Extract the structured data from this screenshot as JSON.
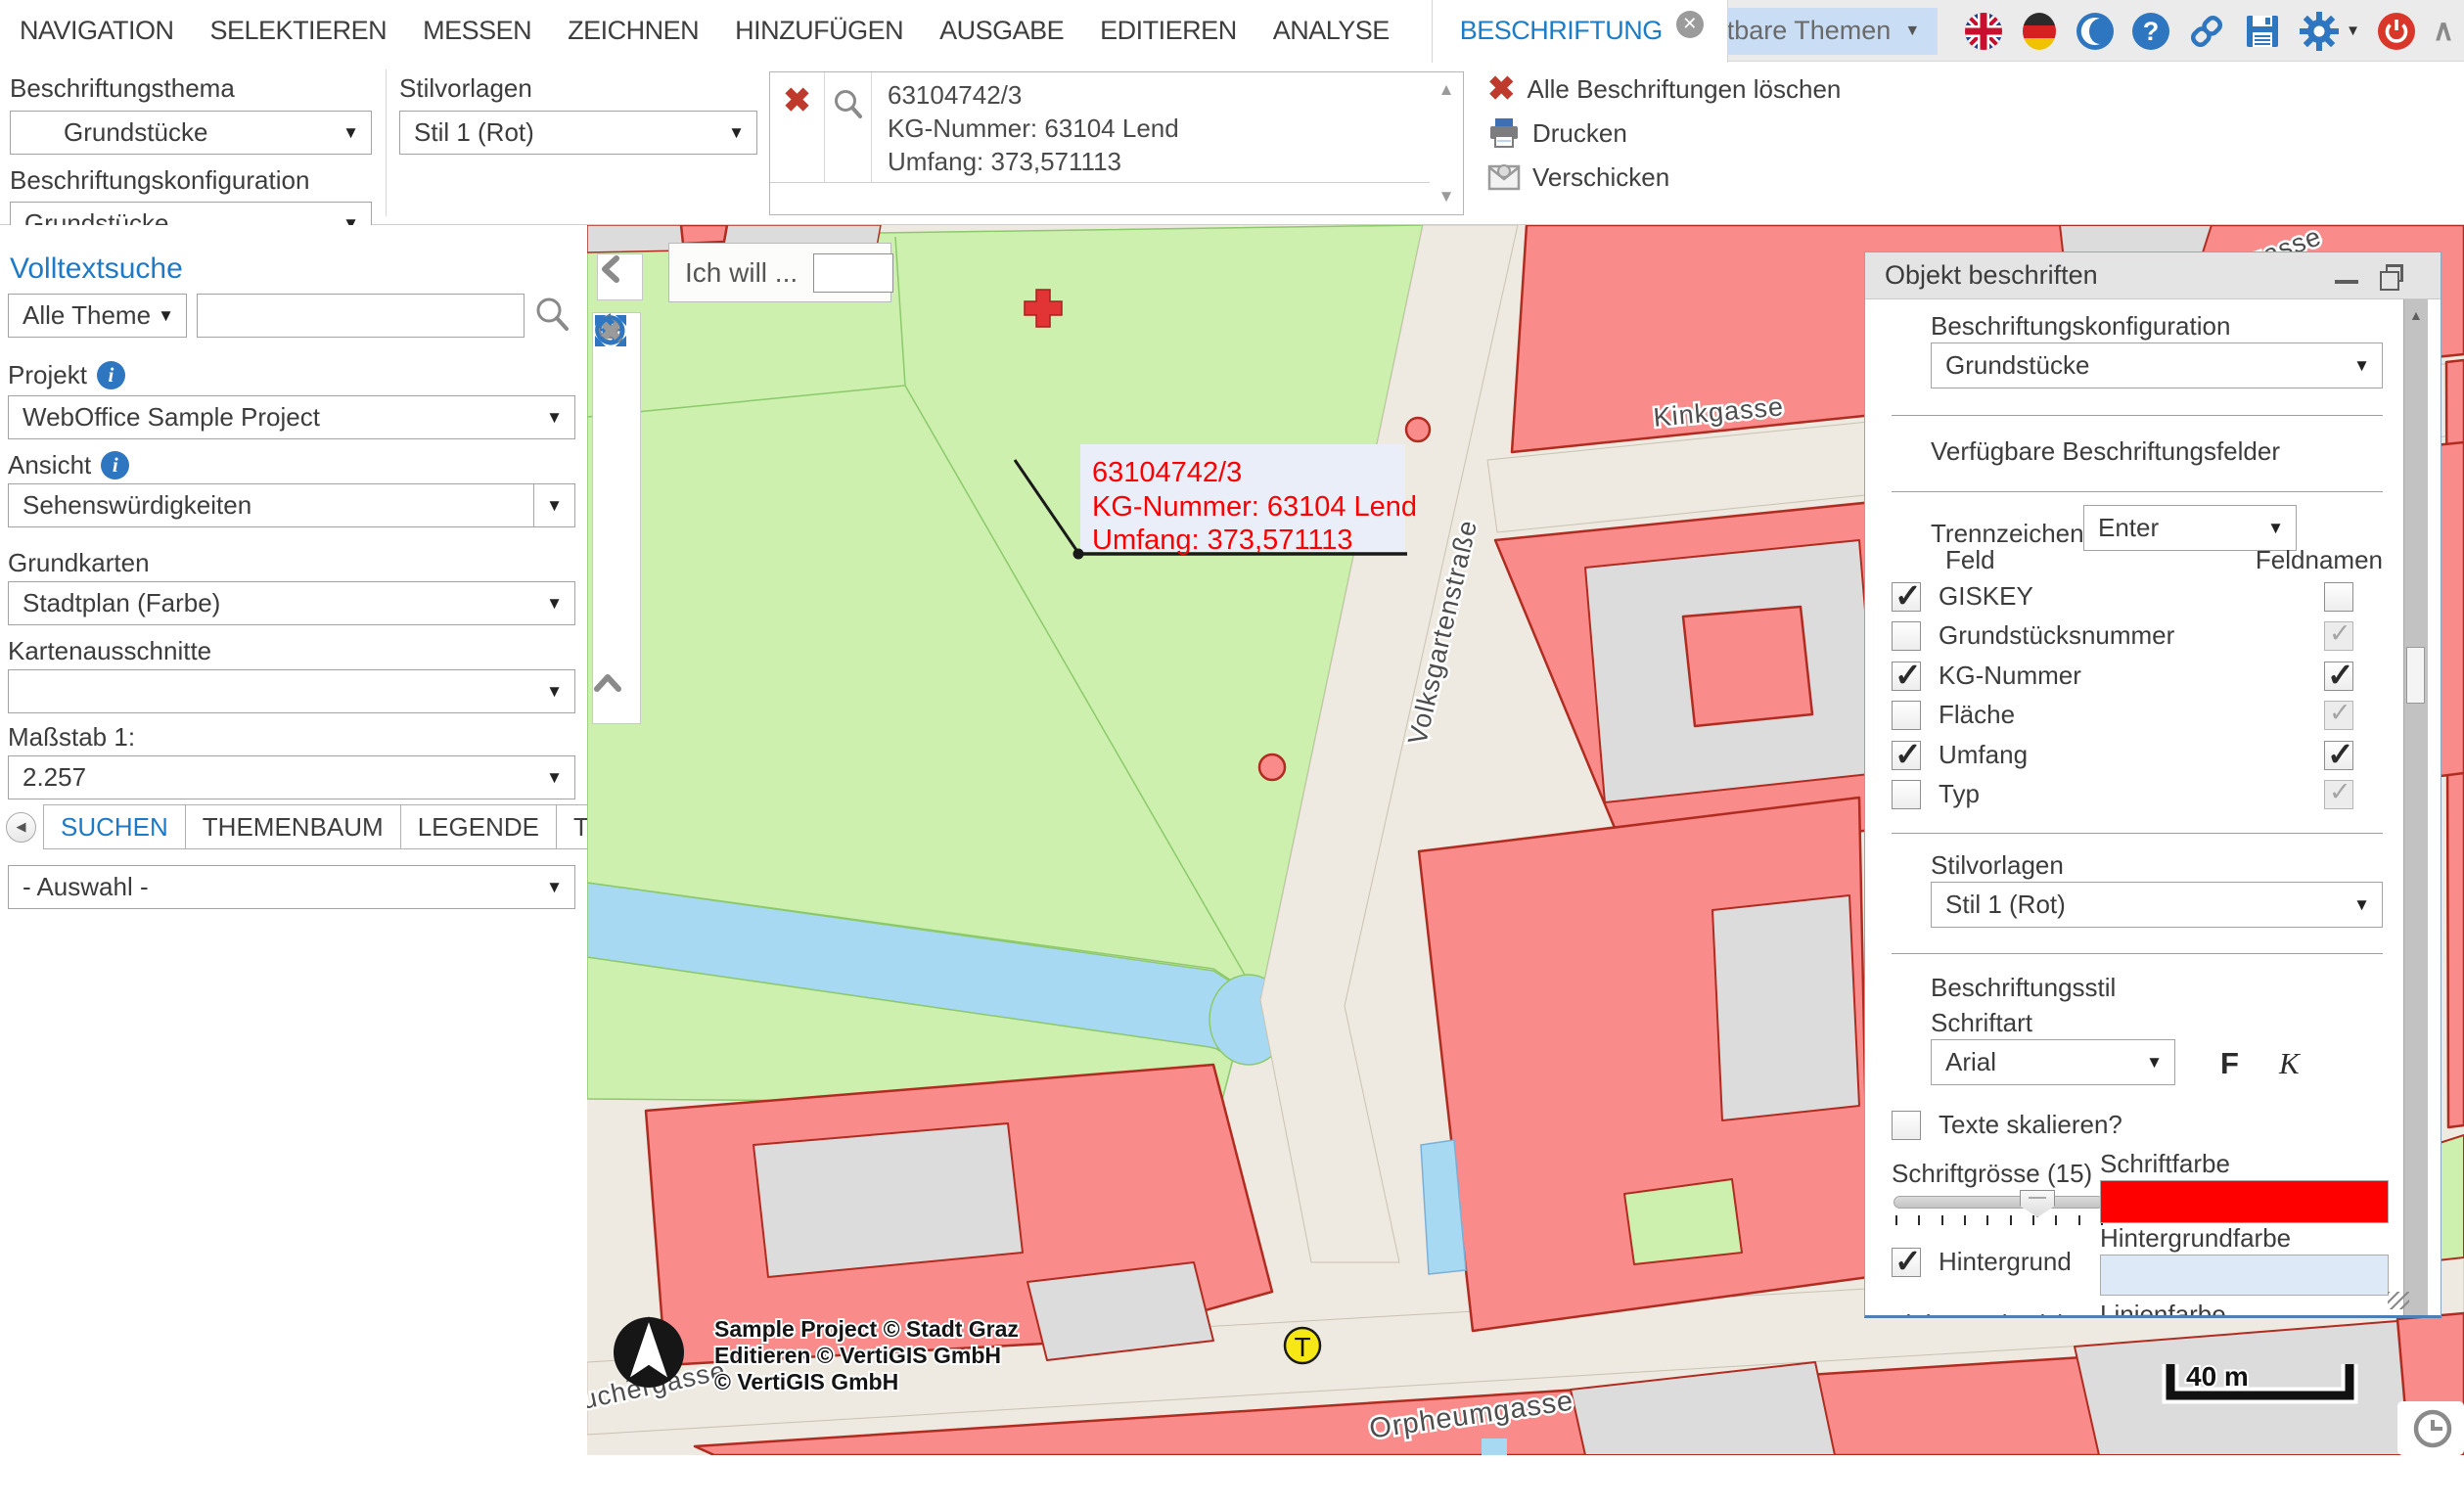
{
  "app": {
    "menu": [
      "NAVIGATION",
      "SELEKTIEREN",
      "MESSEN",
      "ZEICHNEN",
      "HINZUFÜGEN",
      "AUSGABE",
      "EDITIEREN",
      "ANALYSE"
    ],
    "active_tab": "BESCHRIFTUNG",
    "visible_themes_label": "Sichtbare Themen",
    "accent_color": "#1c7cc5"
  },
  "toolbar": {
    "beschriftungsthema_label": "Beschriftungsthema",
    "beschriftungsthema_value": "Grundstücke",
    "beschriftungskonfiguration_label": "Beschriftungskonfiguration",
    "beschriftungskonfiguration_value": "Grundstücke",
    "stilvorlagen_label": "Stilvorlagen",
    "stilvorlagen_value": "Stil 1 (Rot)",
    "result_item": {
      "line1": "63104742/3",
      "line2": "KG-Nummer: 63104 Lend",
      "line3": "Umfang: 373,571113"
    },
    "commands": [
      {
        "label": "Alle Beschriftungen löschen"
      },
      {
        "label": "Drucken"
      },
      {
        "label": "Verschicken"
      }
    ]
  },
  "sidebar": {
    "volltextsuche_label": "Volltextsuche",
    "scope_value": "Alle Themen",
    "search_value": "",
    "projekt_label": "Projekt",
    "projekt_value": "WebOffice Sample Project",
    "ansicht_label": "Ansicht",
    "ansicht_value": "Sehenswürdigkeiten",
    "grundkarten_label": "Grundkarten",
    "grundkarten_value": "Stadtplan (Farbe)",
    "kartenausschnitte_label": "Kartenausschnitte",
    "kartenausschnitte_value": "",
    "massstab_label": "Maßstab 1:",
    "massstab_value": "2.257",
    "tabs": [
      "SUCHEN",
      "THEMENBAUM",
      "LEGENDE",
      "THEM"
    ],
    "auswahl_value": "- Auswahl -"
  },
  "map": {
    "ich_will_label": "Ich will ...",
    "callout": {
      "line1": "63104742/3",
      "line2": "KG-Nummer: 63104 Lend",
      "line3": "Umfang: 373,571113"
    },
    "streets": {
      "kinkgasse": "Kinkgasse",
      "volksgartenstrasse": "Volksgartenstraße",
      "orpheumgasse": "Orpheumgasse",
      "auchergasse": "auchergasse",
      "gasse_partial": "gasse"
    },
    "marker_t": "T",
    "attribution": [
      "Sample Project © Stadt Graz",
      "Editieren © VertiGIS GmbH",
      "© VertiGIS GmbH"
    ],
    "scalebar_label": "40 m",
    "colors": {
      "park": "#cdf0ae",
      "water": "#a8d9f2",
      "building": "#f98b8b",
      "building_outline": "#b02c20",
      "street": "#eeeae1",
      "block_gray": "#dcdcdc",
      "label_red": "#fb0000",
      "label_bg": "#e9eef8"
    }
  },
  "panel": {
    "title": "Objekt beschriften",
    "beschriftungskonfiguration_label": "Beschriftungskonfiguration",
    "beschriftungskonfiguration_value": "Grundstücke",
    "verfuegbare_label": "Verfügbare Beschriftungsfelder",
    "trennzeichen_label": "Trennzeichen",
    "trennzeichen_value": "Enter",
    "feld_header": "Feld",
    "feldnamen_header": "Feldnamen",
    "fields": [
      {
        "label": "GISKEY",
        "feld_state": "checked",
        "feldname_state": "unchecked"
      },
      {
        "label": "Grundstücksnummer",
        "feld_state": "unchecked",
        "feldname_state": "disabled-checked"
      },
      {
        "label": "KG-Nummer",
        "feld_state": "checked",
        "feldname_state": "checked"
      },
      {
        "label": "Fläche",
        "feld_state": "unchecked",
        "feldname_state": "disabled-checked"
      },
      {
        "label": "Umfang",
        "feld_state": "checked",
        "feldname_state": "checked"
      },
      {
        "label": "Typ",
        "feld_state": "unchecked",
        "feldname_state": "disabled-checked"
      }
    ],
    "stilvorlagen_label": "Stilvorlagen",
    "stilvorlagen_value": "Stil 1 (Rot)",
    "beschriftungsstil_label": "Beschriftungsstil",
    "schriftart_label": "Schriftart",
    "schriftart_value": "Arial",
    "bold_button": "F",
    "italic_button": "K",
    "texte_skalieren_label": "Texte skalieren?",
    "texte_skalieren_state": "unchecked",
    "schriftgroesse_label": "Schriftgrösse (15)",
    "schriftgroesse_value": 15,
    "schriftfarbe_label": "Schriftfarbe",
    "schriftfarbe_color": "#fe0000",
    "hintergrund_label": "Hintergrund",
    "hintergrund_state": "checked",
    "hintergrundfarbe_label": "Hintergrundfarbe",
    "hintergrundfarbe_color": "#dde9f6",
    "linienstaerke_label": "Linienstärke (1)",
    "linienstaerke_value": 1,
    "linienfarbe_label": "Linienfarbe",
    "linienfarbe_color": "#1f1f1f"
  }
}
